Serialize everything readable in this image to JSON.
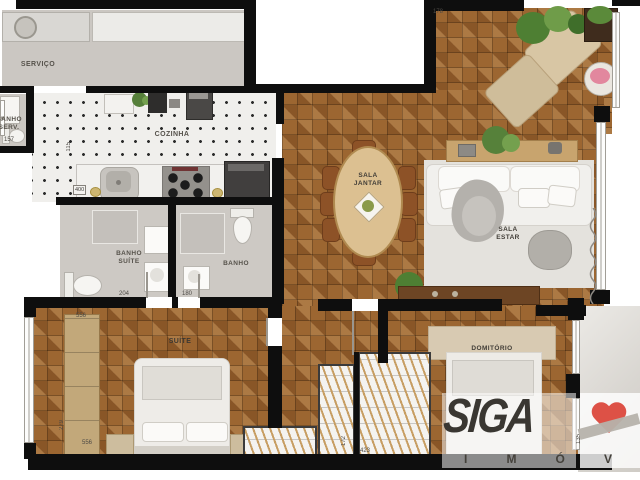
{
  "plan": {
    "rooms": {
      "servico": {
        "label": "SERVIÇO"
      },
      "banho_servico": {
        "label": "BANHO\nSERV.",
        "dim": "157"
      },
      "cozinha": {
        "label": "COZINHA",
        "dim_counter": "400",
        "dim_depth": "115"
      },
      "sala_jantar": {
        "label": "SALA\nJANTAR"
      },
      "sala_estar": {
        "label": "SALA\nESTAR"
      },
      "banho_suite": {
        "label": "BANHO\nSUÍTE",
        "dim": "204"
      },
      "banho": {
        "label": "BANHO",
        "dim": "180"
      },
      "suite": {
        "label": "SUÍTE",
        "dim_top": "556",
        "dim_bottom": "556",
        "dim_side": "279"
      },
      "dormitorio": {
        "label": "DOMITÓRIO"
      },
      "varanda": {
        "dim": "178"
      },
      "closet": {
        "dim": "423",
        "dim_side": "172"
      },
      "terraco": {
        "dim": "135"
      }
    },
    "colors": {
      "wall": "#0e0e0e",
      "wood_floor": "#9c6631",
      "kitchen_floor": "#f0efec",
      "bath_floor": "#cdc9c4"
    }
  },
  "watermark": {
    "brand": "SIGA",
    "letters": [
      "I",
      "M",
      "Ó",
      "V"
    ],
    "heart_color": "#dd5146"
  }
}
